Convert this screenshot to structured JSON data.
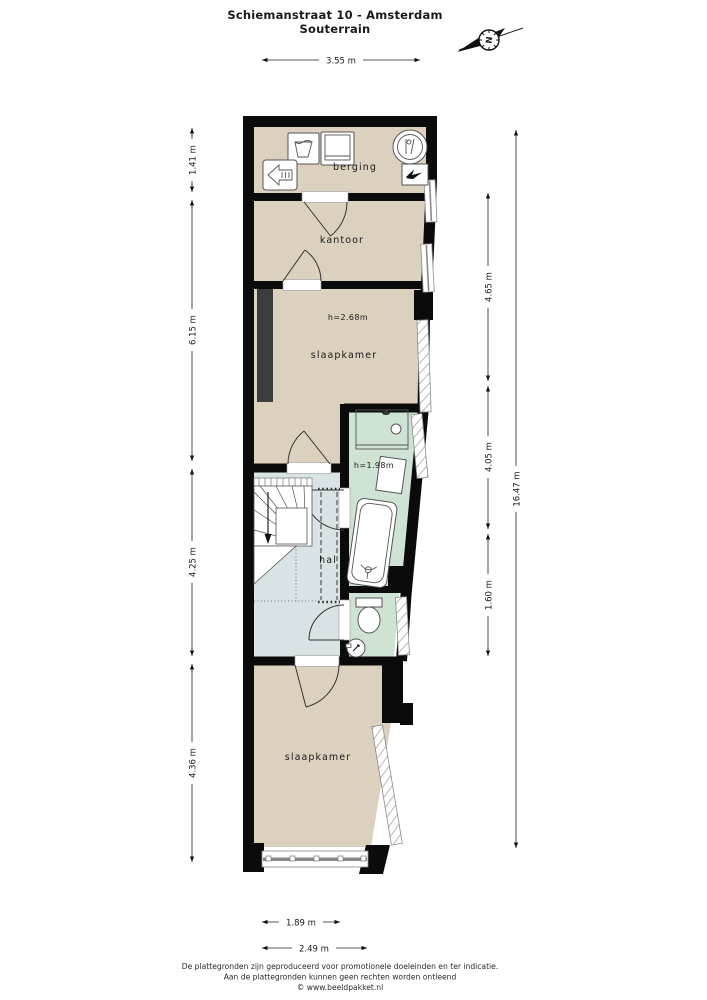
{
  "title": {
    "address": "Schiemanstraat 10 - Amsterdam",
    "floor": "Souterrain"
  },
  "compass": {
    "north_label": "N"
  },
  "rooms": {
    "berging": {
      "label": "berging"
    },
    "kantoor": {
      "label": "kantoor"
    },
    "slaapkamer_1": {
      "label": "slaapkamer",
      "ceiling_height": "h=2.68m"
    },
    "badkamer": {
      "ceiling_height": "h=1.98m"
    },
    "hal": {
      "label": "hal"
    },
    "slaapkamer_2": {
      "label": "slaapkamer"
    }
  },
  "dimensions": {
    "top_width": "3.55 m",
    "left": {
      "berging": "1.41 m",
      "kantoor_slaapkamer": "6.15 m",
      "hal": "4.25 m",
      "slaapkamer_2": "4.36 m"
    },
    "right": {
      "upper": "4.65 m",
      "middle": "4.05 m",
      "lower": "1.60 m",
      "total": "16.47 m"
    },
    "bottom": {
      "inner": "1.89 m",
      "outer": "2.49 m"
    }
  },
  "colors": {
    "floor_beige": "#dcd1be",
    "wet_room_green": "#cee3d3",
    "hallway_blue": "#d9e3e6",
    "wall_black": "#0b0b0b",
    "closet_gray": "#3d3d3d"
  },
  "footer": {
    "line1": "De plattegronden zijn geproduceerd voor promotionele doeleinden en ter indicatie.",
    "line2": "Aan de plattegronden kunnen geen rechten worden ontleend",
    "line3": "© www.beeldpakket.nl"
  }
}
